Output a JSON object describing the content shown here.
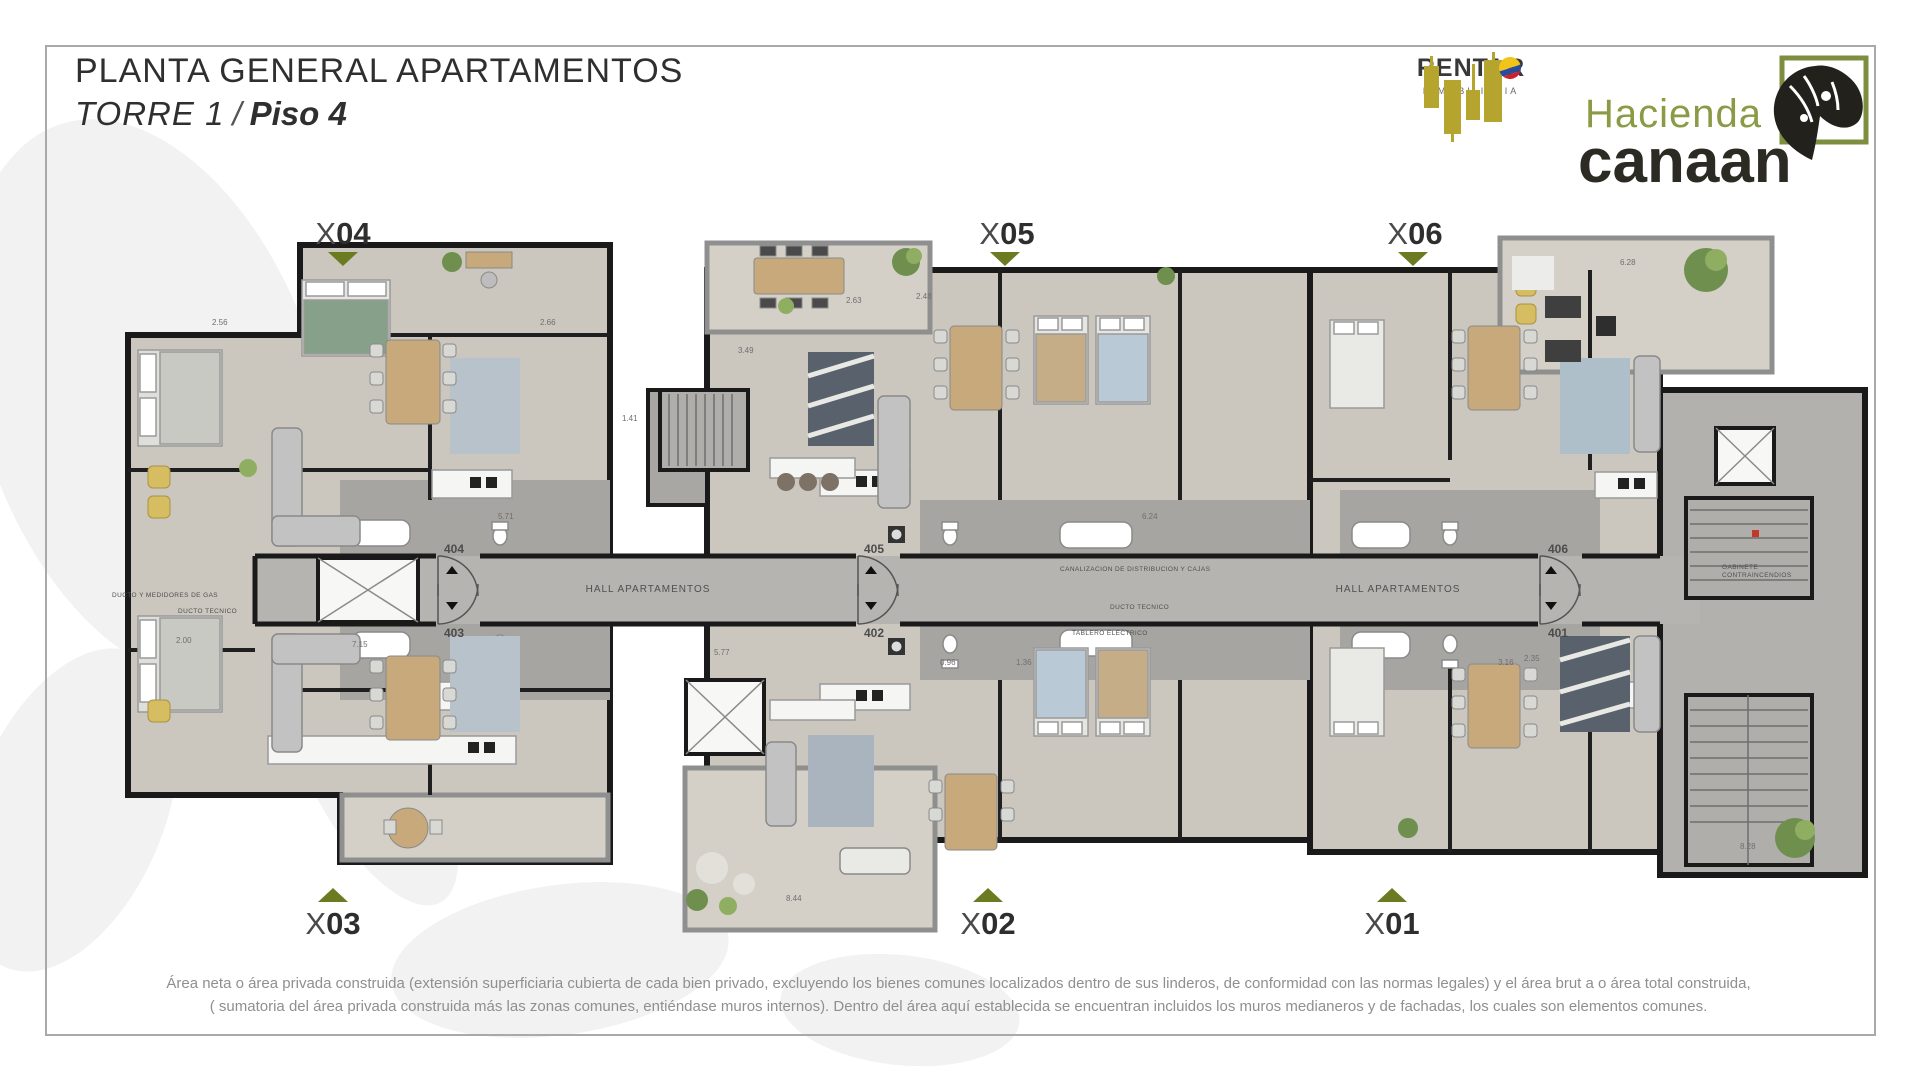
{
  "header": {
    "title": "PLANTA GENERAL APARTAMENTOS",
    "tower": "TORRE 1",
    "separator": "/",
    "floor": "Piso 4"
  },
  "brands": {
    "rentar": {
      "name": "RENTAR",
      "tagline": "INMOBILIARIA"
    },
    "canaan": {
      "line1": "Hacienda",
      "line2": "canaan"
    }
  },
  "units": [
    {
      "prefix": "X",
      "number": "04"
    },
    {
      "prefix": "X",
      "number": "05"
    },
    {
      "prefix": "X",
      "number": "06"
    },
    {
      "prefix": "X",
      "number": "03"
    },
    {
      "prefix": "X",
      "number": "02"
    },
    {
      "prefix": "X",
      "number": "01"
    }
  ],
  "plan": {
    "hall_label": "HALL APARTAMENTOS",
    "door_numbers": [
      "404",
      "403",
      "405",
      "402",
      "406",
      "401"
    ],
    "annotations": {
      "gas_duct": "DUCTO Y MEDIDORES DE GAS",
      "tech_duct": "DUCTO TECNICO",
      "tech_duct_2": "DUCTO TECNICO",
      "electrical": "TABLERO ELECTRICO",
      "distribution": "CANALIZACION DE DISTRIBUCION Y CAJAS",
      "fire_cabinet": "GABINETE CONTRAINCENDIOS"
    },
    "dimensions": [
      "2.56",
      "2.66",
      "2.63",
      "2.48",
      "3.49",
      "5.71",
      "6.24",
      "1.41",
      "2.00",
      "0.96",
      "3.16",
      "7.15",
      "5.77",
      "8.44",
      "6.28",
      "8.28",
      "2.35",
      "1.36"
    ]
  },
  "footer": {
    "line1": "Área neta o área privada construida (extensión superficiaria cubierta de cada bien privado, excluyendo los bienes comunes localizados dentro de sus linderos, de conformidad con las normas legales) y el área brut a o área total construida,",
    "line2": "( sumatoria del área  privada construida más las zonas comunes, entiéndase muros internos). Dentro del área aquí establecida  se encuentran incluidos los muros medianeros y de fachadas,  los cuales son elementos comunes."
  },
  "colors": {
    "accent_olive": "#6b7b21",
    "brand_yellow": "#b5a52f",
    "brand_green": "#8a9a45",
    "wall": "#1a1a1a",
    "floor": "#cbc7be",
    "corridor": "#b6b4b0"
  }
}
